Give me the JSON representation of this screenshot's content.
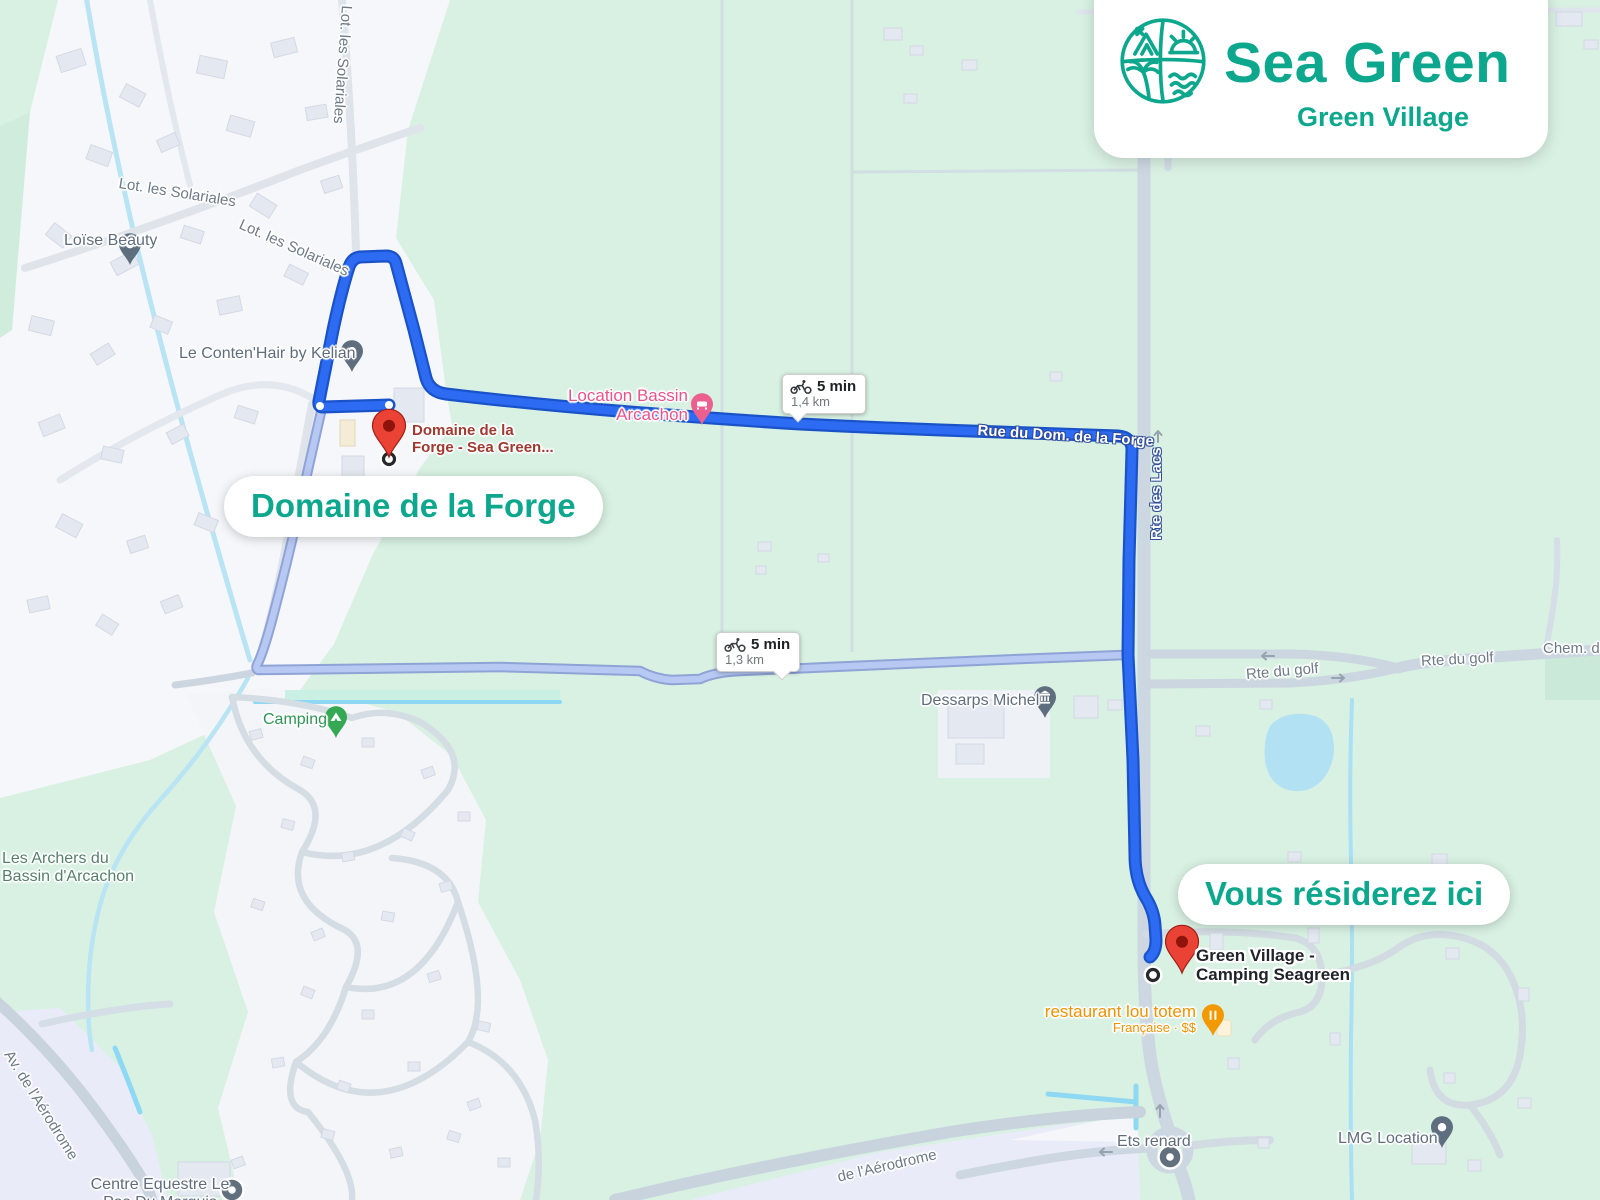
{
  "brand": {
    "title": "Sea Green",
    "subtitle": "Green Village"
  },
  "annotations": {
    "origin_pill": "Domaine de la Forge",
    "destination_pill": "Vous résiderez ici"
  },
  "route_badges": [
    {
      "mode": "bicycle",
      "duration": "5 min",
      "distance": "1,4 km"
    },
    {
      "mode": "bicycle",
      "duration": "5 min",
      "distance": "1,3 km"
    }
  ],
  "markers": {
    "origin": {
      "line1": "Domaine de la",
      "line2": "Forge - Sea Green..."
    },
    "destination": {
      "line1": "Green Village -",
      "line2": "Camping Seagreen"
    }
  },
  "streets": {
    "solariales": "Lot. les Solariales",
    "rue_du_dom": "Rue du Dom. de la Forge",
    "rte_des_lacs": "Rte des Lacs",
    "rte_du_golf": "Rte du golf",
    "chem": "Chem. d",
    "av_aerodrome": "Av. de l'Aérodrome",
    "aerodrome_partial": "de l'Aérodrome"
  },
  "pois": {
    "loise": "Loïse Beauty",
    "contenhair": "Le Conten'Hair by Kelian",
    "location_bassin": {
      "line1": "Location Bassin",
      "line2": "Arcachon"
    },
    "dessarps": "Dessarps Michel",
    "camping": "Camping",
    "archers": {
      "line1": "Les Archers du",
      "line2": "Bassin d'Arcachon"
    },
    "restaurant": {
      "line1": "restaurant lou totem",
      "line2": "Française · $$"
    },
    "ets": "Ets renard",
    "lmg": "LMG Location",
    "equestre": {
      "line1": "Centre Equestre Le",
      "line2": "Pas Du Marquis"
    }
  },
  "colors": {
    "brand_teal": "#0ca78c",
    "route_primary": "#2c6bf2",
    "route_alternative": "#b7c8f3",
    "marker_red": "#ea4335"
  }
}
